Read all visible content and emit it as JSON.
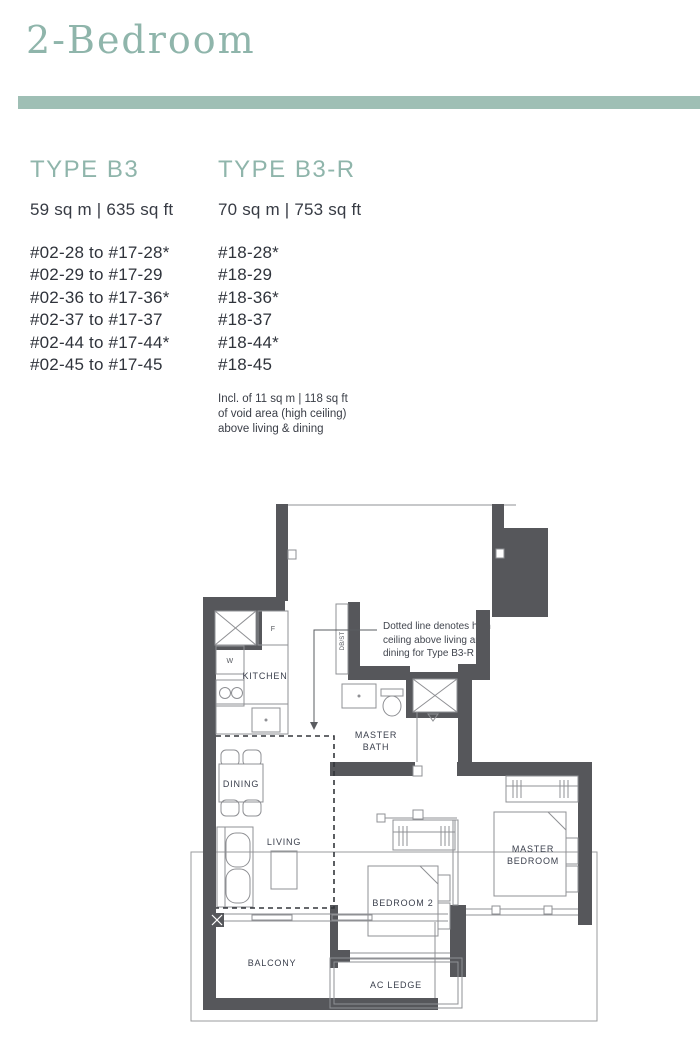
{
  "page": {
    "title": "2-Bedroom"
  },
  "colors": {
    "accent": "#8FB5AB",
    "divider_bar": "#9FBFB5",
    "body_text": "#2F333B",
    "wall": "#56575B"
  },
  "types": [
    {
      "name": "TYPE B3",
      "area": "59 sq m | 635 sq ft",
      "units": [
        "#02-28 to #17-28*",
        "#02-29 to #17-29",
        "#02-36 to #17-36*",
        "#02-37 to #17-37",
        "#02-44 to #17-44*",
        "#02-45 to #17-45"
      ]
    },
    {
      "name": "TYPE B3-R",
      "area": "70 sq m | 753 sq ft",
      "units": [
        "#18-28*",
        "#18-29",
        "#18-36*",
        "#18-37",
        "#18-44*",
        "#18-45"
      ],
      "note_lines": [
        "Incl. of 11 sq m | 118 sq ft",
        "of void area (high ceiling)",
        "above living & dining"
      ]
    }
  ],
  "plan": {
    "annotation_lines": [
      "Dotted line denotes high",
      "ceiling above living and",
      "dining for Type B3-R"
    ],
    "labels": {
      "kitchen": "KITCHEN",
      "dining": "DINING",
      "living": "LIVING",
      "master": "MASTER",
      "bath": "BATH",
      "bedroom": "BEDROOM",
      "bedroom2": "BEDROOM 2",
      "balcony": "BALCONY",
      "ac_ledge": "AC LEDGE",
      "washer": "W",
      "fridge": "F",
      "db_st": "DB/ST"
    }
  }
}
